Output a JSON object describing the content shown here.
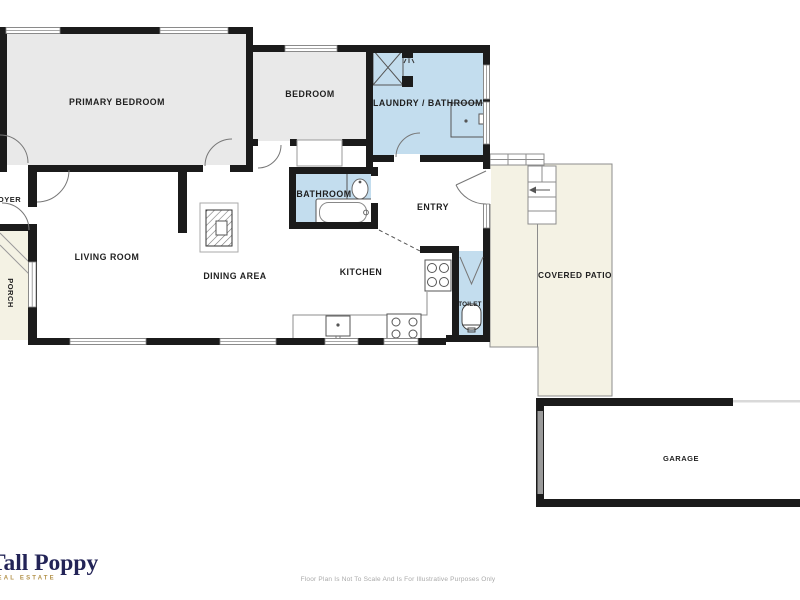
{
  "floor_plan": {
    "labels": {
      "primary_bedroom": "PRIMARY BEDROOM",
      "bedroom": "BEDROOM",
      "laundry_bathroom": "LAUNDRY / BATHROOM",
      "bathroom": "BATHROOM",
      "entry": "ENTRY",
      "foyer": "FOYER",
      "living_room": "LIVING ROOM",
      "dining_area": "DINING AREA",
      "kitchen": "KITCHEN",
      "toilet": "TOILET",
      "porch": "PORCH",
      "covered_patio": "COVERED PATIO",
      "garage": "GARAGE"
    },
    "colors": {
      "wall": "#1b1b1b",
      "bedroom_fill": "#e9e9e9",
      "wet_room_fill": "#c3ddee",
      "outdoor_fill": "#f4f2e4",
      "thin_line": "#8c8c8c",
      "label_text": "#1f1f1f"
    }
  },
  "branding": {
    "logo_text": "Tall Poppy",
    "logo_subtext": "REAL ESTATE",
    "logo_color": "#232457",
    "logo_accent": "#b3924a"
  },
  "footer": {
    "disclaimer": "Floor Plan Is Not To Scale And Is For Illustrative Purposes Only"
  }
}
